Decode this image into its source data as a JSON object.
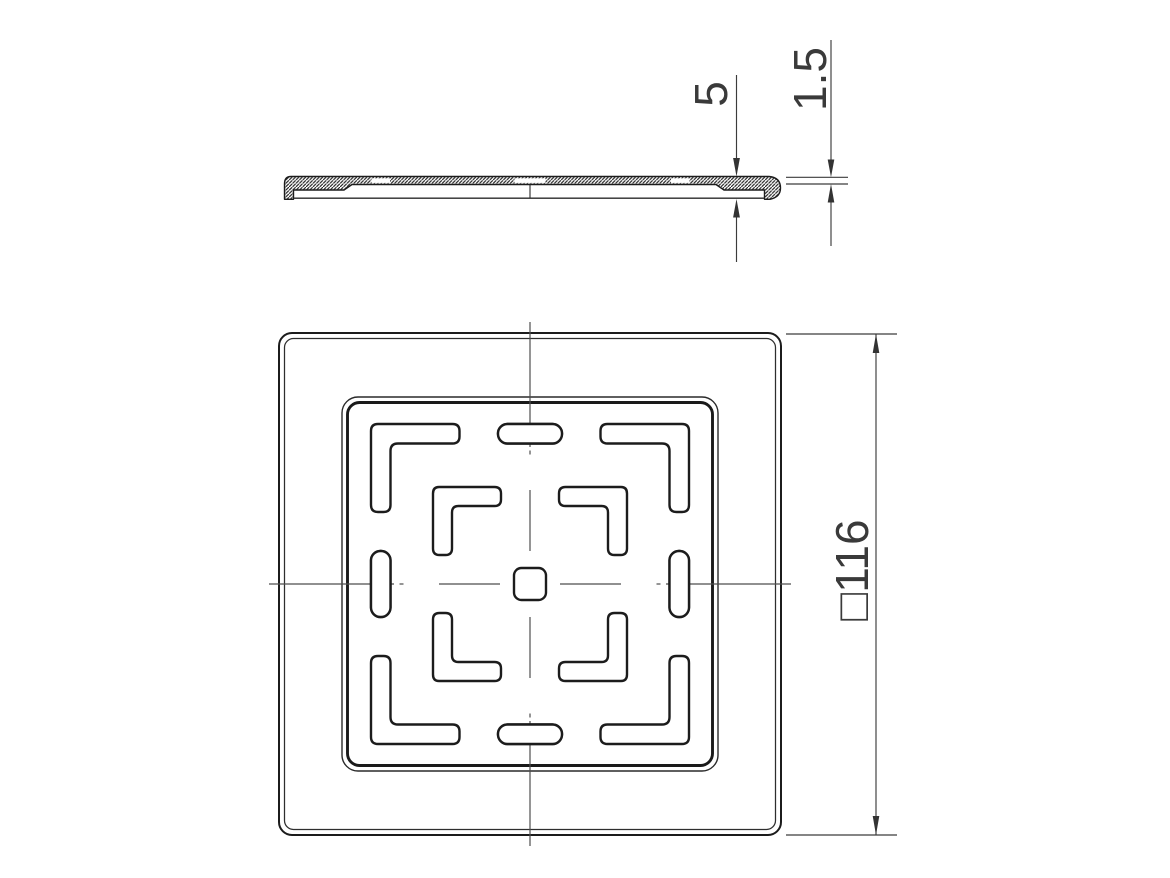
{
  "drawing": {
    "type": "technical-drawing",
    "background_color": "#ffffff",
    "line_color": "#1c1c1c",
    "dimension_color": "#3a3a3a",
    "views": {
      "section_view": "side profile section of cover plate",
      "plan_view": "top view of square cover plate with slot pattern"
    },
    "dimensions": {
      "overall_thickness": "5",
      "plate_thickness": "1.5",
      "outer_size": "□116"
    }
  }
}
